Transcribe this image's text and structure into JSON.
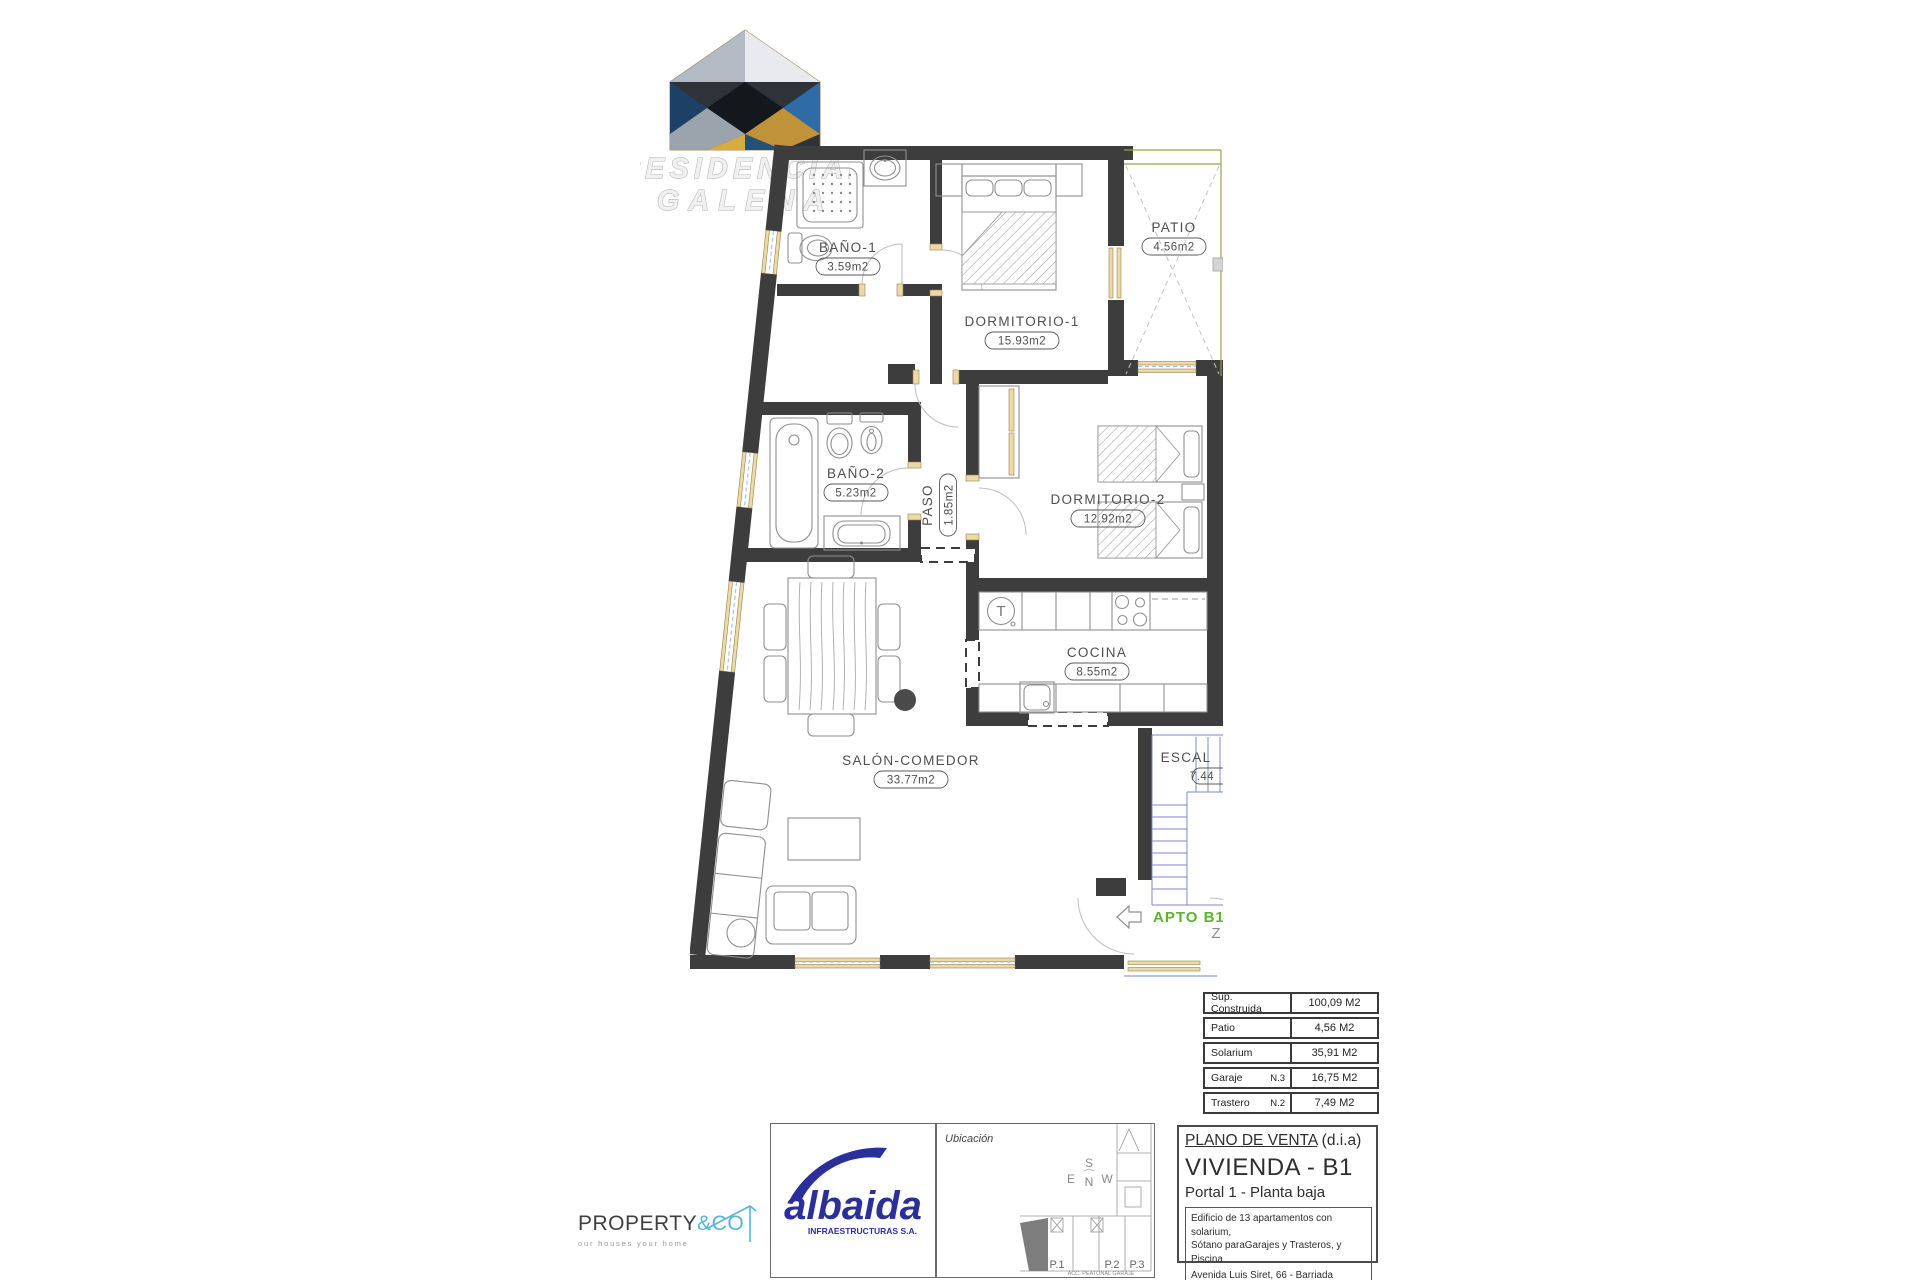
{
  "brand": {
    "line1": "RESIDENCIAL",
    "line2": "GALENA"
  },
  "plan": {
    "rooms": {
      "bano1": {
        "name": "BAÑO-1",
        "area": "3.59m2"
      },
      "dormitorio1": {
        "name": "DORMITORIO-1",
        "area": "15.93m2"
      },
      "patio": {
        "name": "PATIO",
        "area": "4.56m2"
      },
      "bano2": {
        "name": "BAÑO-2",
        "area": "5.23m2"
      },
      "paso": {
        "name": "PASO",
        "area": "1.85m2"
      },
      "dormitorio2": {
        "name": "DORMITORIO-2",
        "area": "12.92m2"
      },
      "cocina": {
        "name": "COCINA",
        "area": "8.55m2"
      },
      "salon": {
        "name": "SALÓN-COMEDOR",
        "area": "33.77m2"
      },
      "escalera": {
        "name": "ESCAL",
        "area": "7.44"
      }
    },
    "apto_label": "APTO B1",
    "z_mark": "Z",
    "washer_mark": "T"
  },
  "summary_table": {
    "rows": [
      {
        "label": "Sup. Construida",
        "note": "",
        "value": "100,09 M2"
      },
      {
        "label": "Patio",
        "note": "",
        "value": "4,56 M2"
      },
      {
        "label": "Solarium",
        "note": "",
        "value": "35,91 M2"
      },
      {
        "label": "Garaje",
        "note": "N.3",
        "value": "16,75 M2"
      },
      {
        "label": "Trastero",
        "note": "N.2",
        "value": "7,49 M2"
      }
    ]
  },
  "title_block": {
    "doc_type_main": "PLANO DE VENTA",
    "doc_type_suffix": " (d.i.a)",
    "unit": "VIVIENDA - B1",
    "portal": "Portal 1 - Planta baja",
    "desc_line1": "Edificio de 13 apartamentos con solarium,",
    "desc_line2": "Sótano paraGarajes y Trasteros, y Piscina",
    "addr_line1": "Avenida Luis Siret, 66 - Barriada HERRERÍAS",
    "addr_line2": "T.M. CUEVAS DE ALMANZORA (Almería)"
  },
  "location": {
    "label": "Ubicación",
    "compass": {
      "n": "N",
      "s": "S",
      "e": "E",
      "w": "W"
    },
    "portals": [
      "P.1",
      "P.2",
      "P.3"
    ],
    "footnote": "ACC. PEATONAL GARAJE"
  },
  "partners": {
    "property": {
      "word": "PROPERTY",
      "accent": "&CO",
      "tagline": "our houses your home"
    },
    "albaida": {
      "word": "albaida",
      "subtitle": "INFRAESTRUCTURAS S.A."
    }
  },
  "colors": {
    "wall": "#3d3d3d",
    "frame": "#ecd9a8",
    "patio_line": "#a0a040",
    "stairs_blue": "#8089c9",
    "apto_green": "#5cb431",
    "label_gray": "#4f4f4f",
    "albaida_blue": "#2b2f9c",
    "property_cyan": "#56b6d6"
  }
}
